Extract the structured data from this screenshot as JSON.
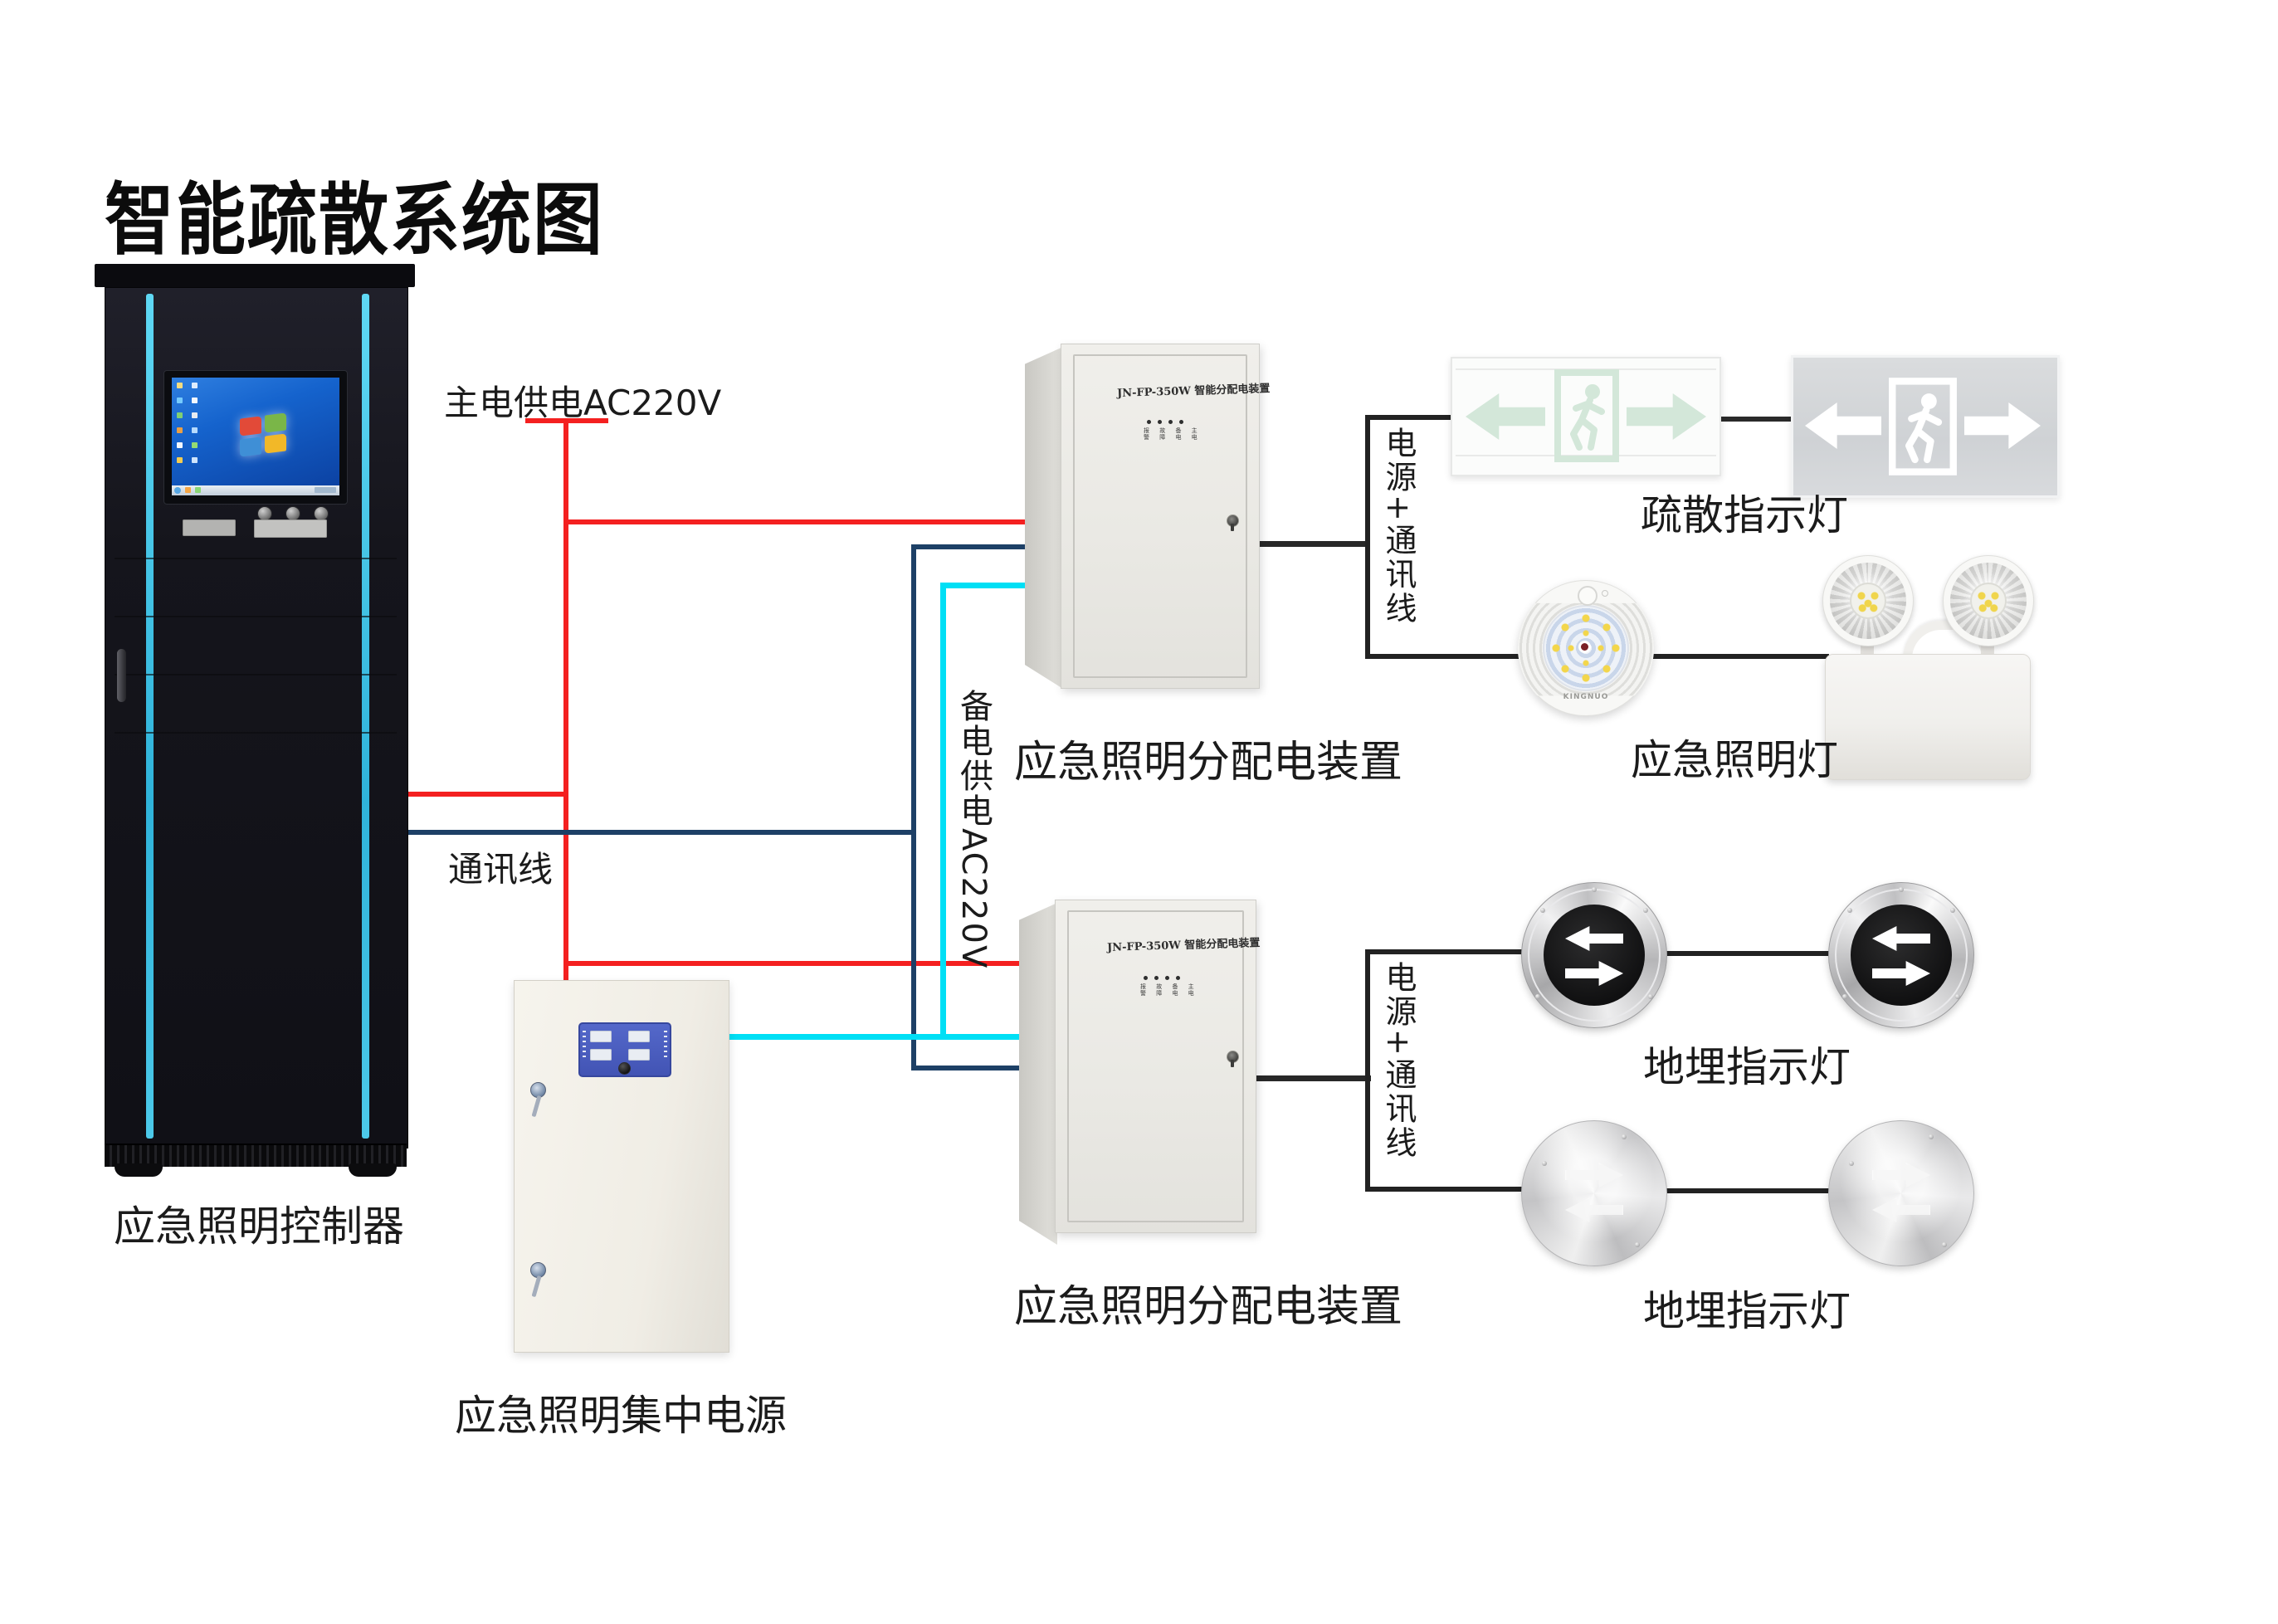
{
  "title": "智能疏散系统图",
  "wiring": {
    "main_power_label": "主电供电AC220V",
    "comm_label": "通讯线",
    "backup_power_label": "备电供电AC220V",
    "power_comm_label": "电源+通讯线",
    "colors": {
      "main_power_line": "#f42020",
      "comm_line": "#1d4066",
      "backup_power_line": "#00dff5",
      "connector_line": "#282828",
      "rack_accent": "#45c8e8"
    }
  },
  "devices": {
    "controller": {
      "label": "应急照明控制器"
    },
    "central_power": {
      "label": "应急照明集中电源"
    },
    "distribution": {
      "label": "应急照明分配电装置",
      "panel_title": "JN-FP-350W 智能分配电装置",
      "led_row1": "报 故 备 主",
      "led_row2": "警 障 电 电"
    },
    "evac_sign": {
      "label": "疏散指示灯"
    },
    "emergency_lamp": {
      "label": "应急照明灯",
      "brand": "KINGNUO"
    },
    "buried_light": {
      "label": "地埋指示灯"
    }
  }
}
